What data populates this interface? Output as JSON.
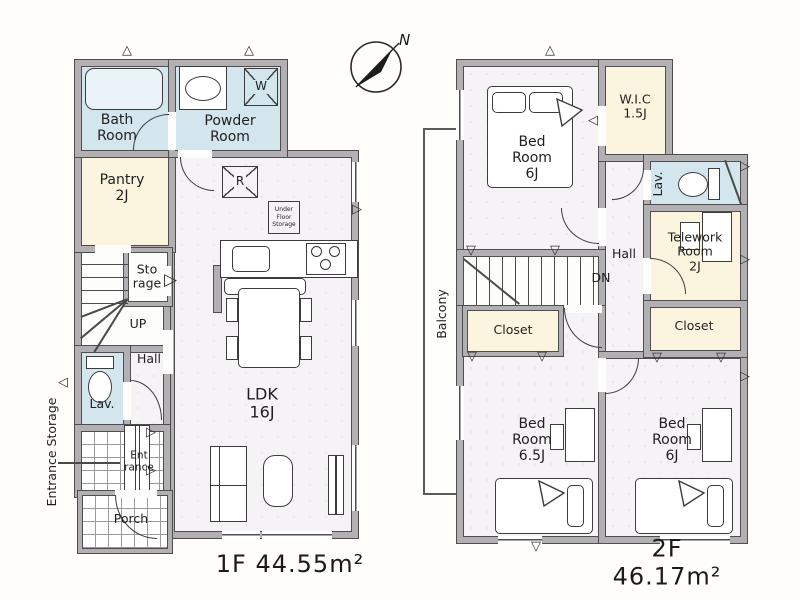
{
  "compass": {
    "label": "N"
  },
  "floor1": {
    "area_label": "1F 44.55m²",
    "rooms": {
      "bath": "Bath\nRoom",
      "powder": "Powder\nRoom",
      "pantry": "Pantry\n2J",
      "storage": "Sto\nrage",
      "up": "UP",
      "hall": "Hall",
      "lav": "Lav.",
      "entrance": "Ent\nrance",
      "entrance_storage": "Entrance Storage",
      "porch": "Porch",
      "ldk": "LDK\n16J"
    },
    "fixtures": {
      "washer": "W",
      "fridge": "R",
      "under_floor_storage": "Under\nFloor\nStorage"
    }
  },
  "floor2": {
    "area_label": "2F 46.17m²",
    "rooms": {
      "bedroom_main": "Bed\nRoom\n6J",
      "wic": "W.I.C\n1.5J",
      "lav": "Lav.",
      "telework": "Telework\nRoom\n2J",
      "hall": "Hall",
      "down": "DN",
      "closet_left": "Closet",
      "closet_right": "Closet",
      "bedroom_65": "Bed\nRoom\n6.5J",
      "bedroom_6": "Bed\nRoom\n6J",
      "balcony": "Balcony"
    }
  },
  "colors": {
    "wall": "#b2b0b3",
    "wall_edge": "#4e4e4e",
    "wet_room": "#d3e6ee",
    "storage_room": "#fbf5df",
    "floor": "#f5f3f5",
    "background": "#fffefb"
  }
}
